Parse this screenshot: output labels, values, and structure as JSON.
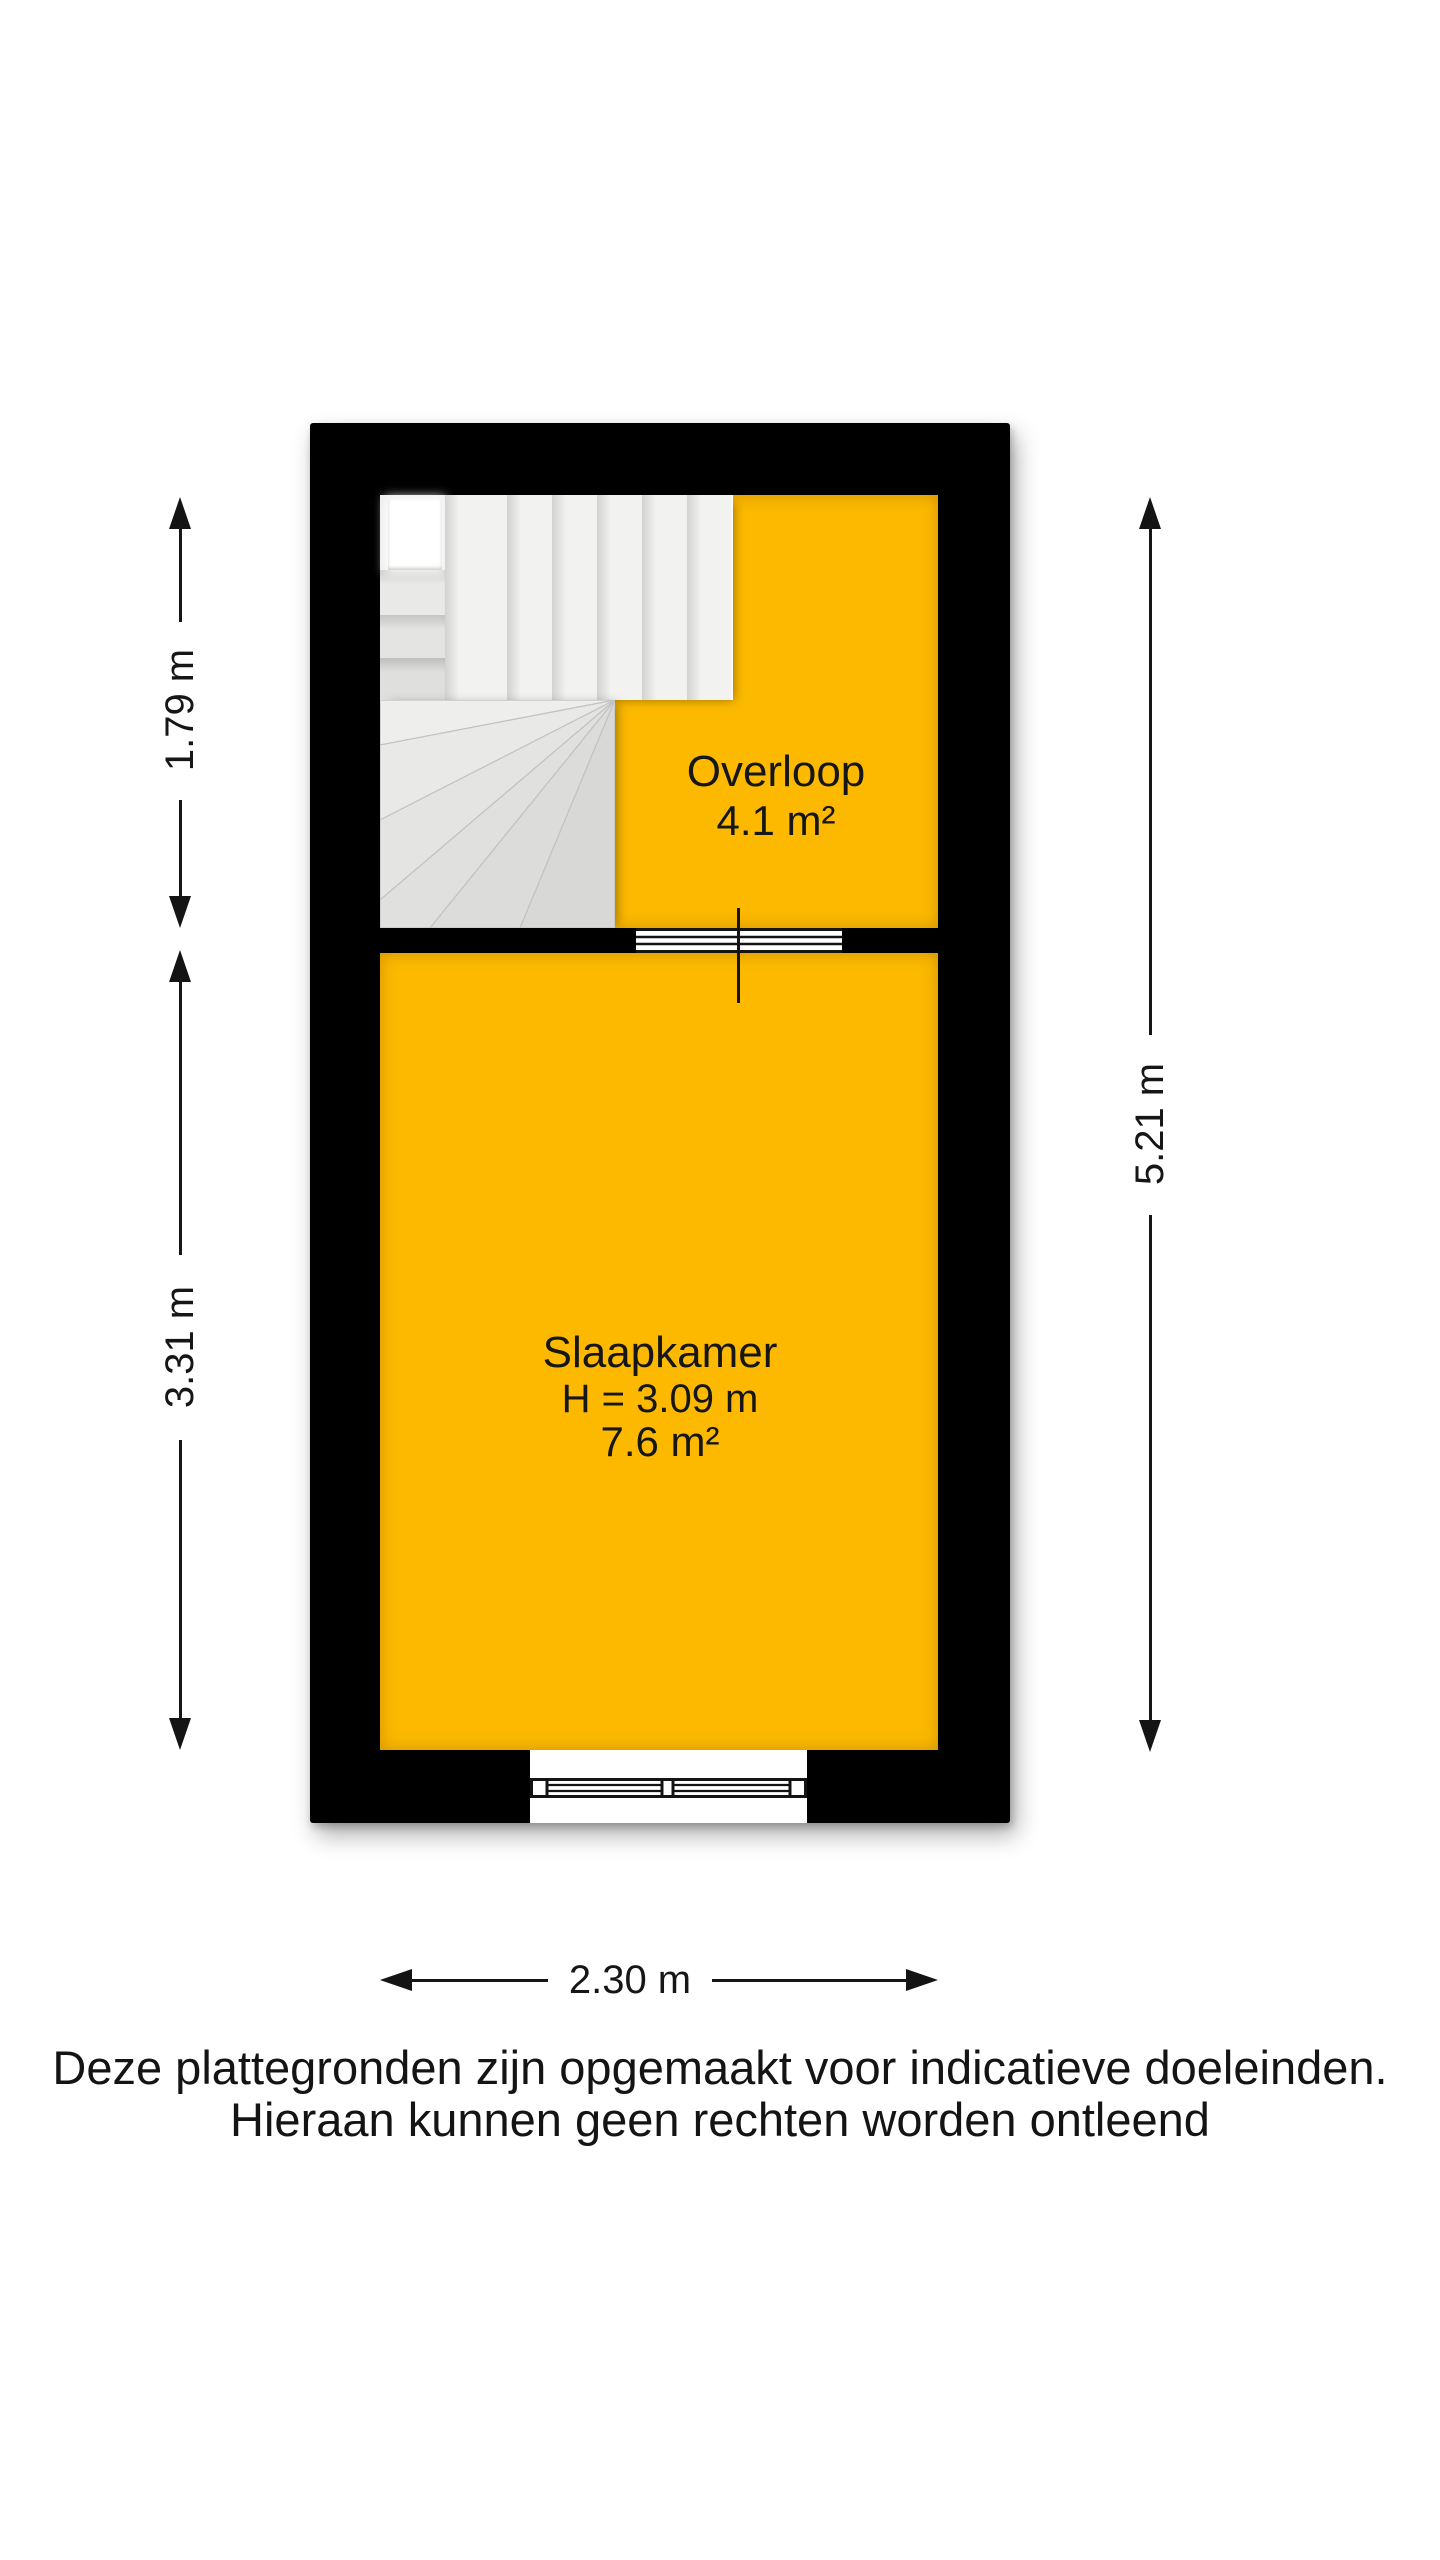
{
  "colors": {
    "floor": "#fcb900",
    "wall": "#000000",
    "tread": "#f1f1f0",
    "text": "#1a1a1a"
  },
  "rooms": {
    "overloop": {
      "name": "Overloop",
      "area": "4.1 m²"
    },
    "slaapkamer": {
      "name": "Slaapkamer",
      "ceiling_height": "H = 3.09 m",
      "area": "7.6 m²"
    }
  },
  "dimensions": {
    "overloop_depth": "1.79 m",
    "slaapkamer_depth": "3.31 m",
    "total_depth": "5.21 m",
    "width": "2.30 m"
  },
  "footer": {
    "line1": "Deze plattegronden zijn opgemaakt voor indicatieve doeleinden.",
    "line2": "Hieraan kunnen geen rechten worden ontleend"
  }
}
